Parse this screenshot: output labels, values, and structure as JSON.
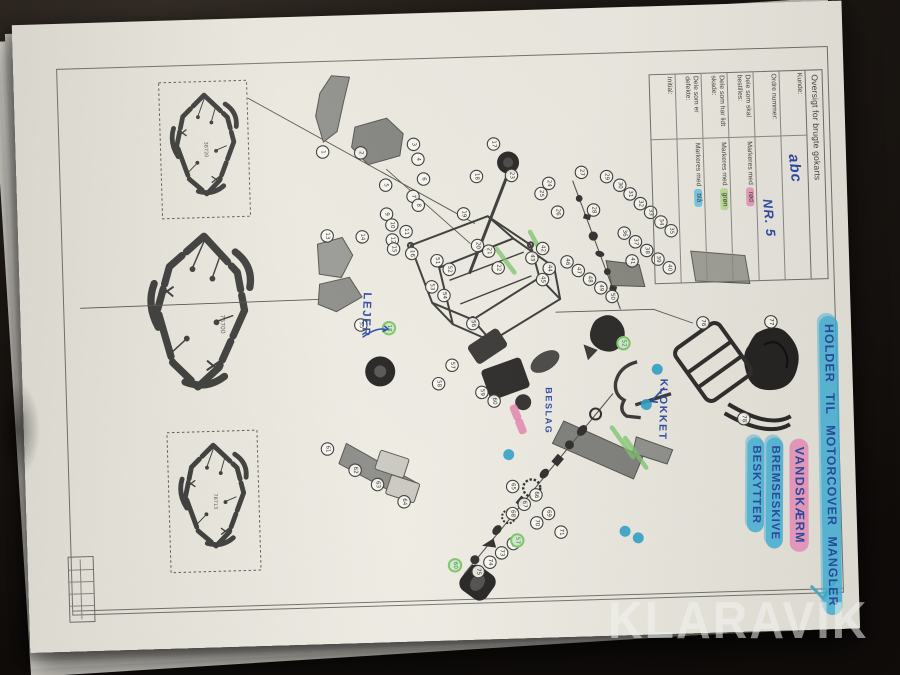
{
  "photo": {
    "watermark": "KLARAVIK"
  },
  "colors": {
    "pen_blue": "#2b4aa0",
    "marker_blue": "#2e9fc6",
    "marker_pink": "#e583ad",
    "marker_green": "#7cc46a",
    "ink": "#3a3a38",
    "paper": "#eae7de"
  },
  "table": {
    "title": "Oversigt for brugte gokarts",
    "rows": [
      {
        "label": "Kunde:",
        "hand": "abc"
      },
      {
        "label": "Ordre nummer:",
        "hand": "NR. 5"
      },
      {
        "label": "Dele som skal bestilles:",
        "value": "Markeres med",
        "mark": "rød"
      },
      {
        "label": "Dele som har lidt skade:",
        "value": "Markeres med",
        "mark": "grøn"
      },
      {
        "label": "Dele som er defekte:",
        "value": "Markeres med",
        "mark": "blå"
      },
      {
        "label": "Initial:",
        "value": ""
      }
    ]
  },
  "notes": {
    "pen": [
      {
        "text": "LEJER"
      },
      {
        "text": "BESLAG"
      },
      {
        "text": "KLOKKET"
      }
    ],
    "marker": [
      {
        "text": "HOLDER TIL MOTORCOVER MANGLER",
        "highlight": "blue"
      },
      {
        "text": "VANDSKÆRM",
        "highlight": "pink"
      },
      {
        "text_line1": "BREMSESKIVE",
        "text_line2": "BESKYTTER",
        "highlight": "blue"
      }
    ]
  },
  "frames": [
    {
      "label": "38720"
    },
    {
      "label": "76700"
    },
    {
      "label": "78713"
    }
  ],
  "diagram": {
    "markers": [
      [
        307,
        136,
        "1"
      ],
      [
        345,
        138,
        "2"
      ],
      [
        398,
        131,
        "3"
      ],
      [
        402,
        146,
        "4"
      ],
      [
        369,
        171,
        "5"
      ],
      [
        407,
        166,
        "6"
      ],
      [
        396,
        183,
        "7"
      ],
      [
        401,
        192,
        "8"
      ],
      [
        369,
        200,
        "9"
      ],
      [
        374,
        211,
        "10"
      ],
      [
        388,
        218,
        "11"
      ],
      [
        374,
        226,
        "12"
      ],
      [
        309,
        220,
        "13"
      ],
      [
        344,
        222,
        "14"
      ],
      [
        375,
        235,
        "15"
      ],
      [
        393,
        240,
        "16"
      ],
      [
        478,
        133,
        "17"
      ],
      [
        460,
        165,
        "18"
      ],
      [
        446,
        202,
        "19"
      ],
      [
        459,
        234,
        "20"
      ],
      [
        470,
        240,
        "21"
      ],
      [
        479,
        257,
        "22"
      ],
      [
        495,
        165,
        "23"
      ],
      [
        532,
        174,
        "24"
      ],
      [
        524,
        184,
        "25"
      ],
      [
        540,
        203,
        "26"
      ],
      [
        565,
        164,
        "27"
      ],
      [
        576,
        202,
        "28"
      ],
      [
        590,
        169,
        "29"
      ],
      [
        603,
        178,
        "30"
      ],
      [
        613,
        187,
        "31"
      ],
      [
        623,
        197,
        "32"
      ],
      [
        633,
        206,
        "33"
      ],
      [
        643,
        216,
        "34"
      ],
      [
        653,
        225,
        "35"
      ],
      [
        606,
        226,
        "36"
      ],
      [
        617,
        235,
        "37"
      ],
      [
        628,
        244,
        "38"
      ],
      [
        639,
        253,
        "39"
      ],
      [
        650,
        262,
        "40"
      ],
      [
        613,
        254,
        "41"
      ],
      [
        524,
        239,
        "42"
      ],
      [
        513,
        248,
        "43"
      ],
      [
        530,
        259,
        "44"
      ],
      [
        523,
        270,
        "45"
      ],
      [
        548,
        253,
        "46"
      ],
      [
        559,
        262,
        "47"
      ],
      [
        570,
        271,
        "48"
      ],
      [
        581,
        280,
        "49"
      ],
      [
        592,
        289,
        "50"
      ],
      [
        418,
        248,
        "51"
      ],
      [
        430,
        257,
        "52"
      ],
      [
        412,
        274,
        "53"
      ],
      [
        424,
        283,
        "54"
      ],
      [
        340,
        310,
        "55"
      ],
      [
        452,
        312,
        "56"
      ],
      [
        430,
        353,
        "57"
      ],
      [
        416,
        371,
        "58"
      ],
      [
        459,
        381,
        "59"
      ],
      [
        471,
        390,
        "60"
      ],
      [
        303,
        433,
        "61"
      ],
      [
        330,
        455,
        "62"
      ],
      [
        352,
        470,
        "63"
      ],
      [
        378,
        488,
        "64"
      ],
      [
        487,
        476,
        "65"
      ],
      [
        510,
        485,
        "66"
      ],
      [
        498,
        494,
        "67"
      ],
      [
        486,
        503,
        "68"
      ],
      [
        522,
        504,
        "69"
      ],
      [
        510,
        513,
        "70"
      ],
      [
        534,
        523,
        "71"
      ],
      [
        486,
        533,
        "72"
      ],
      [
        474,
        542,
        "73"
      ],
      [
        462,
        551,
        "74"
      ],
      [
        450,
        560,
        "75"
      ],
      [
        682,
        318,
        "76"
      ],
      [
        750,
        319,
        "77"
      ],
      [
        720,
        415,
        "78"
      ],
      [
        368,
        314,
        "18",
        "green"
      ],
      [
        602,
        336,
        "52",
        "green"
      ],
      [
        427,
        553,
        "60",
        "green"
      ],
      [
        490,
        530,
        "57",
        "green"
      ]
    ],
    "teal_dots": [
      [
        635,
        363
      ],
      [
        623,
        398
      ],
      [
        484,
        444
      ],
      [
        598,
        524
      ],
      [
        611,
        531
      ]
    ],
    "pink_dabs": [
      [
        492,
        402
      ],
      [
        497,
        416
      ]
    ],
    "green_strokes": [
      [
        478,
        238,
        495,
        262
      ],
      [
        512,
        222,
        522,
        242
      ],
      [
        588,
        420,
        608,
        450
      ],
      [
        601,
        431,
        621,
        461
      ]
    ]
  }
}
